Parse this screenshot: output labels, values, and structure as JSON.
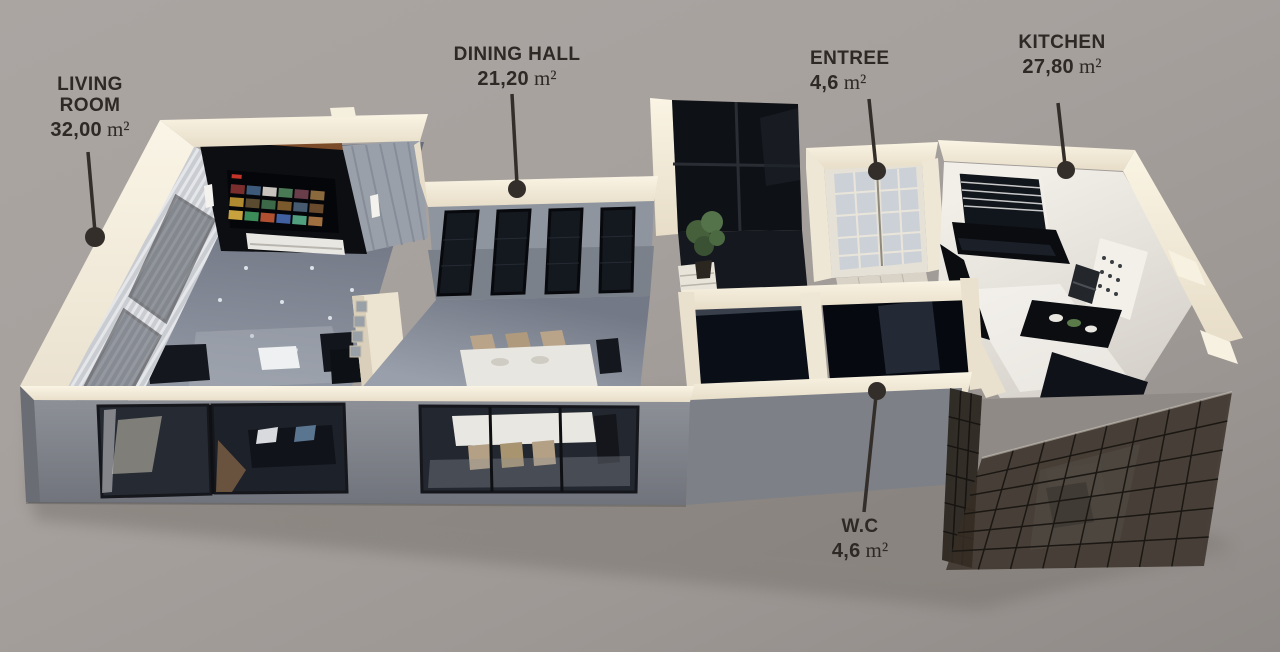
{
  "units": {
    "area": "m²"
  },
  "rooms": [
    {
      "id": "living-room",
      "name_lines": [
        "LIVING",
        "ROOM"
      ],
      "area": "32,00"
    },
    {
      "id": "dining-hall",
      "name_lines": [
        "DINING HALL"
      ],
      "area": "21,20"
    },
    {
      "id": "entree",
      "name_lines": [
        "ENTREE"
      ],
      "area": "4,6"
    },
    {
      "id": "kitchen",
      "name_lines": [
        "KITCHEN"
      ],
      "area": "27,80"
    },
    {
      "id": "wc",
      "name_lines": [
        "W.C"
      ],
      "area": "4,6"
    }
  ],
  "colors": {
    "background": "#a7a19e",
    "wall_top_cream": "#f1e9d8",
    "interior_wall_gray": "#8f959e",
    "floor_gray": "#7e838e",
    "dark_glass": "#14171d",
    "media_wall_black": "#0c0e12",
    "wood_accent": "#7b4a28",
    "kitchen_counter_black": "#0a0c10",
    "label_text": "#2e2925"
  }
}
